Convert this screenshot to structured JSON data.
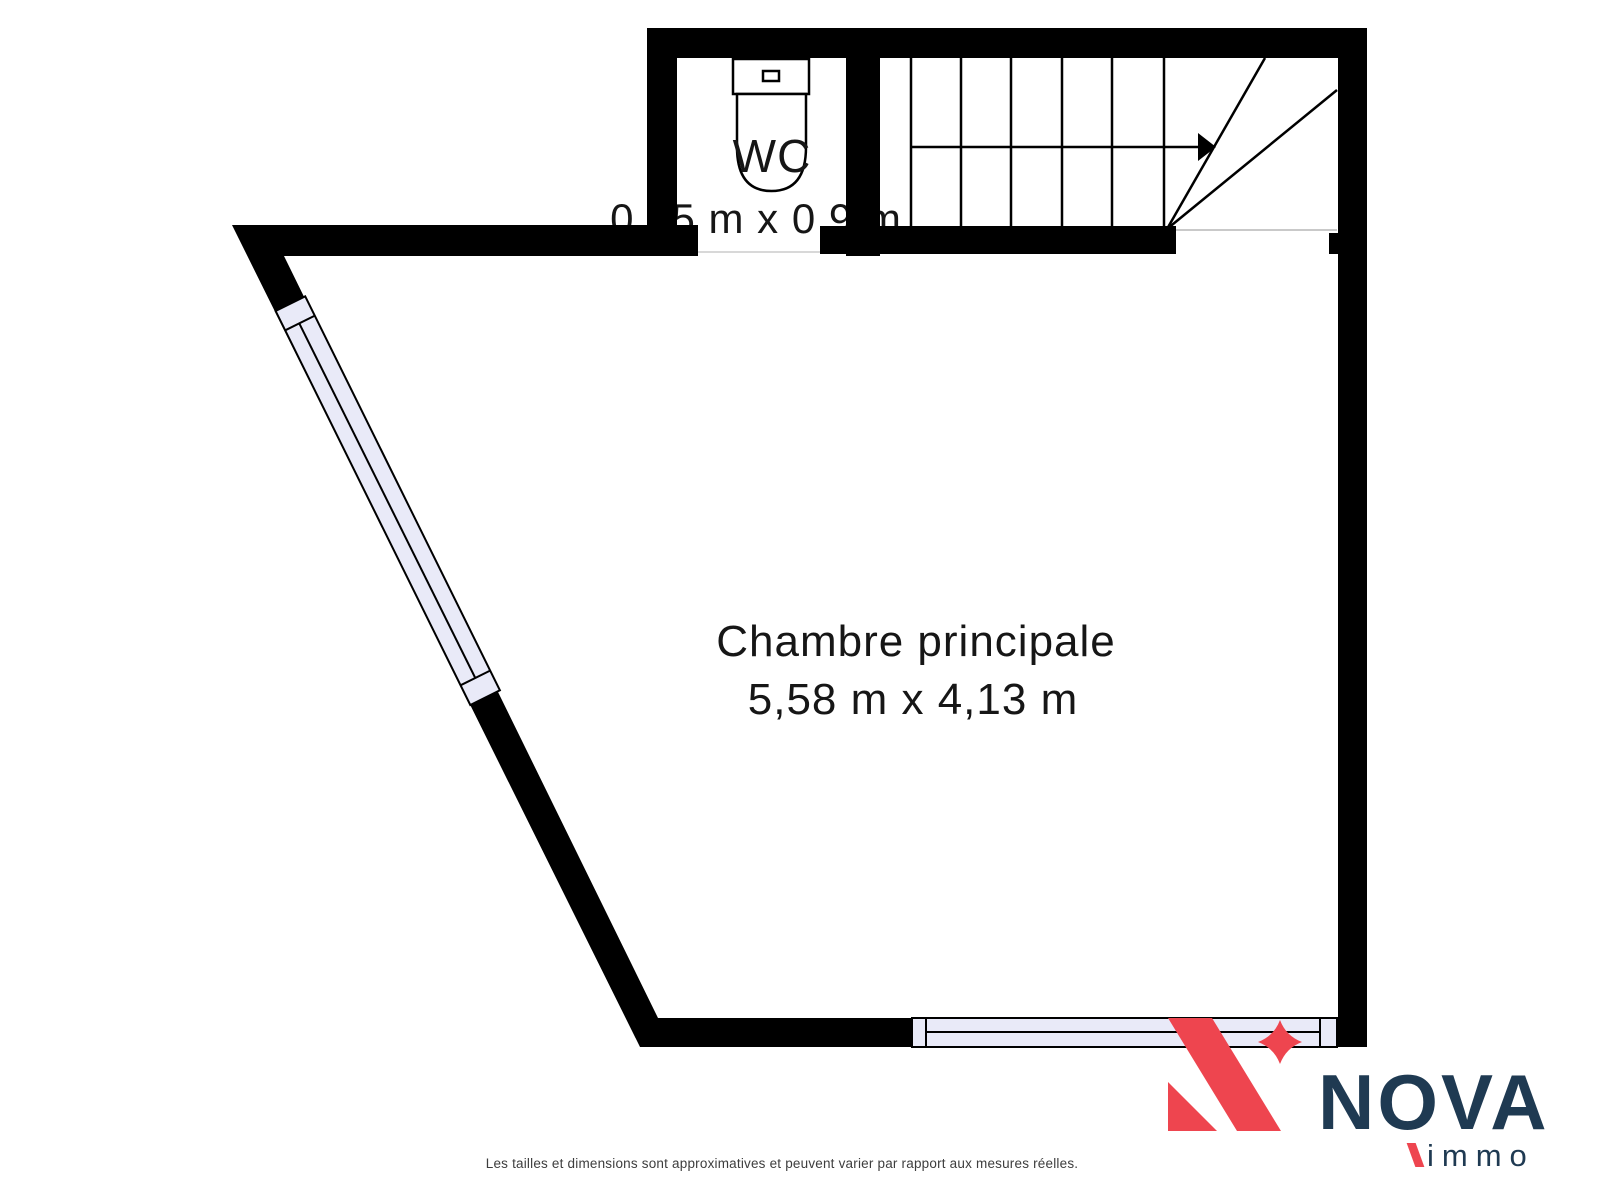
{
  "plan": {
    "wc": {
      "label": "WC",
      "dimensions": "0,95 m x 0,9 m"
    },
    "main_room": {
      "label": "Chambre principale",
      "dimensions": "5,58 m x 4,13 m"
    }
  },
  "logo": {
    "brand": "NOVA",
    "suffix": "immo"
  },
  "disclaimer": "Les tailles et dimensions sont approximatives et peuvent varier par rapport aux mesures réelles.",
  "colors": {
    "wall": "#000000",
    "window_fill": "#E9EAF8",
    "logo_red": "#EE454F",
    "logo_navy": "#1F3A52",
    "disclaimer_text": "#3D3D3D"
  }
}
